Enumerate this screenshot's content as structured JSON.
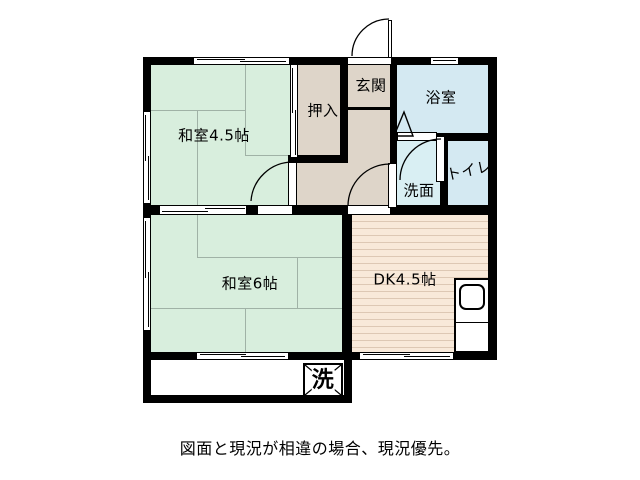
{
  "floorplan": {
    "rooms": {
      "washitsu45": {
        "label": "和室4.5帖"
      },
      "oshiire": {
        "label": "押入"
      },
      "genkan": {
        "label": "玄関"
      },
      "bath": {
        "label": "浴室"
      },
      "senmen": {
        "label": "洗面"
      },
      "toilet": {
        "label": "トイレ"
      },
      "washitsu6": {
        "label": "和室6帖"
      },
      "dk": {
        "label": "DK4.5帖"
      }
    },
    "symbols": {
      "washer": "洗"
    },
    "caption": "図面と現況が相違の場合、現況優先。",
    "colors": {
      "wall": "#000000",
      "tatami_green": "#d8eedd",
      "tatami_grid": "#a0b2a6",
      "closet_beige": "#ded5c9",
      "bath_blue": "#d4e9f2",
      "senmen_blue": "#d9eff3",
      "dk_floor": "#f8e9d9",
      "dk_stripe": "#ddc8b4"
    }
  }
}
